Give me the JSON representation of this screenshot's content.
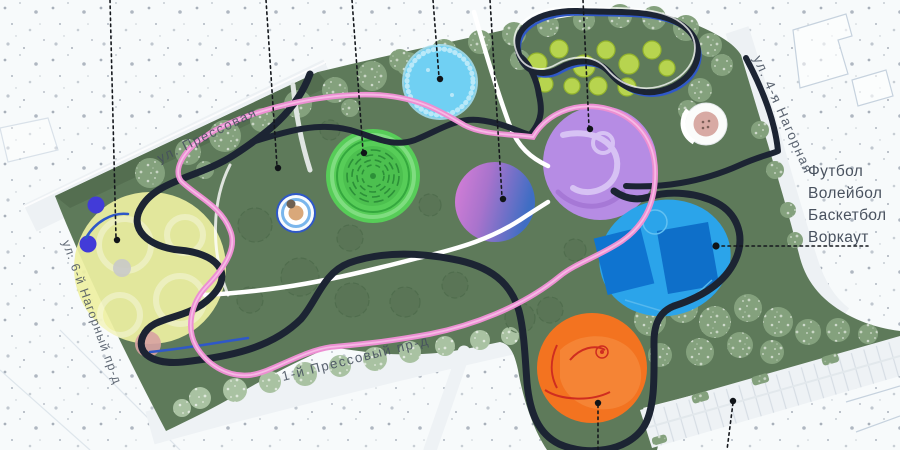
{
  "streets": {
    "pressovaya": {
      "label": "ул. Прессовая"
    },
    "nagornaya_4": {
      "label": "ул. 4-я Нагорная"
    },
    "nagorny_6_proezd": {
      "label": "ул. 6-й Нагорный пр-д"
    },
    "pressovy_1_proezd": {
      "label": "1-й Прессовый пр-д"
    }
  },
  "sports_legend": {
    "items": [
      {
        "label": "Футбол"
      },
      {
        "label": "Волейбол"
      },
      {
        "label": "Баскетбол"
      },
      {
        "label": "Воркаут"
      }
    ]
  },
  "zones": [
    {
      "id": "pale-yellow-zone",
      "fill": "#eef0a2"
    },
    {
      "id": "light-blue-pond-zone",
      "fill": "#70d0f3"
    },
    {
      "id": "green-maze-zone",
      "fill": "#57cd58"
    },
    {
      "id": "pink-blue-gradient-zone",
      "fill_from": "#d97fd8",
      "fill_to": "#3f6ec4"
    },
    {
      "id": "purple-swirl-zone",
      "fill": "#b68ce4"
    },
    {
      "id": "blue-sports-court-zone",
      "fill": "#2ba4ea"
    },
    {
      "id": "orange-zone",
      "fill": "#f37320"
    }
  ],
  "colors": {
    "lawn": "#5e7a5a",
    "main_path": "#1c2433",
    "loop_path": "#ec8fd2",
    "secondary_path": "#2f58c8",
    "walkway": "#ffffff",
    "background": "#f7fafb"
  }
}
